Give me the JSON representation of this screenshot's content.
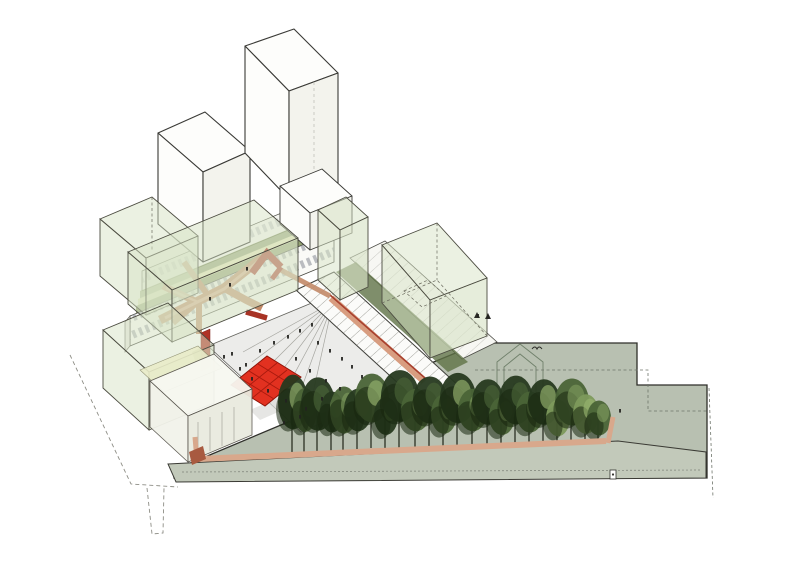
{
  "figure": {
    "kind": "architectural axonometric site diagram",
    "visible_text": []
  },
  "palette": {
    "outline": "#3a3a36",
    "site_plane": "#b8c0b1",
    "deck": "#c2c9ba",
    "plaza": "#ececea",
    "green_volume": "#d8e3c6",
    "green_roof": "#8a9a66",
    "pale_roof": "#e3e6ba",
    "dark_strip": "#5f7246",
    "walkway": "#c28a68",
    "walkway_hl": "#dcab8e",
    "ramp_red": "#a83325",
    "wall_red": "#b03226",
    "court_red": "#e23120",
    "court_grid": "#a81a0e",
    "salmon_path": "#d8a88c",
    "salmon_wall": "#d89d80",
    "tree_dark": "#26391f",
    "tree_deep": "#17260f",
    "tree_mid": "#4a6437",
    "tree_light": "#7d9a5c",
    "tree_highlight": "#97b36f",
    "dash": "#8d8d85",
    "figure_dark": "#232320",
    "window": "#8e949b"
  },
  "scene": {
    "trees": [
      [
        292,
        460,
        72,
        15,
        0
      ],
      [
        304,
        454,
        58,
        12,
        1
      ],
      [
        317,
        460,
        70,
        17,
        0
      ],
      [
        331,
        452,
        54,
        12,
        0
      ],
      [
        343,
        458,
        62,
        14,
        1
      ],
      [
        357,
        452,
        56,
        14,
        0
      ],
      [
        371,
        448,
        64,
        17,
        1
      ],
      [
        385,
        452,
        50,
        12,
        0
      ],
      [
        399,
        450,
        68,
        19,
        0
      ],
      [
        415,
        452,
        56,
        15,
        1
      ],
      [
        429,
        448,
        62,
        17,
        0
      ],
      [
        443,
        452,
        52,
        13,
        1
      ],
      [
        457,
        450,
        66,
        18,
        0
      ],
      [
        472,
        452,
        56,
        15,
        1
      ],
      [
        487,
        448,
        60,
        16,
        0
      ],
      [
        501,
        452,
        50,
        13,
        1
      ],
      [
        515,
        450,
        64,
        17,
        0
      ],
      [
        529,
        452,
        54,
        14,
        1
      ],
      [
        543,
        448,
        60,
        16,
        0
      ],
      [
        557,
        452,
        48,
        12,
        2
      ],
      [
        571,
        450,
        62,
        17,
        1
      ],
      [
        585,
        452,
        52,
        13,
        2
      ],
      [
        598,
        450,
        46,
        12,
        1
      ]
    ],
    "people": [
      [
        232,
        355
      ],
      [
        246,
        366
      ],
      [
        260,
        352
      ],
      [
        274,
        344
      ],
      [
        288,
        338
      ],
      [
        300,
        332
      ],
      [
        312,
        326
      ],
      [
        318,
        344
      ],
      [
        330,
        352
      ],
      [
        342,
        360
      ],
      [
        352,
        368
      ],
      [
        362,
        378
      ],
      [
        340,
        390
      ],
      [
        322,
        400
      ],
      [
        306,
        410
      ],
      [
        286,
        402
      ],
      [
        268,
        392
      ],
      [
        252,
        380
      ],
      [
        240,
        370
      ],
      [
        296,
        360
      ],
      [
        310,
        372
      ],
      [
        326,
        382
      ],
      [
        284,
        424
      ],
      [
        300,
        418
      ],
      [
        224,
        358
      ],
      [
        230,
        286
      ],
      [
        247,
        270
      ],
      [
        210,
        300
      ],
      [
        478,
        317
      ],
      [
        488,
        318
      ],
      [
        620,
        412
      ]
    ]
  }
}
